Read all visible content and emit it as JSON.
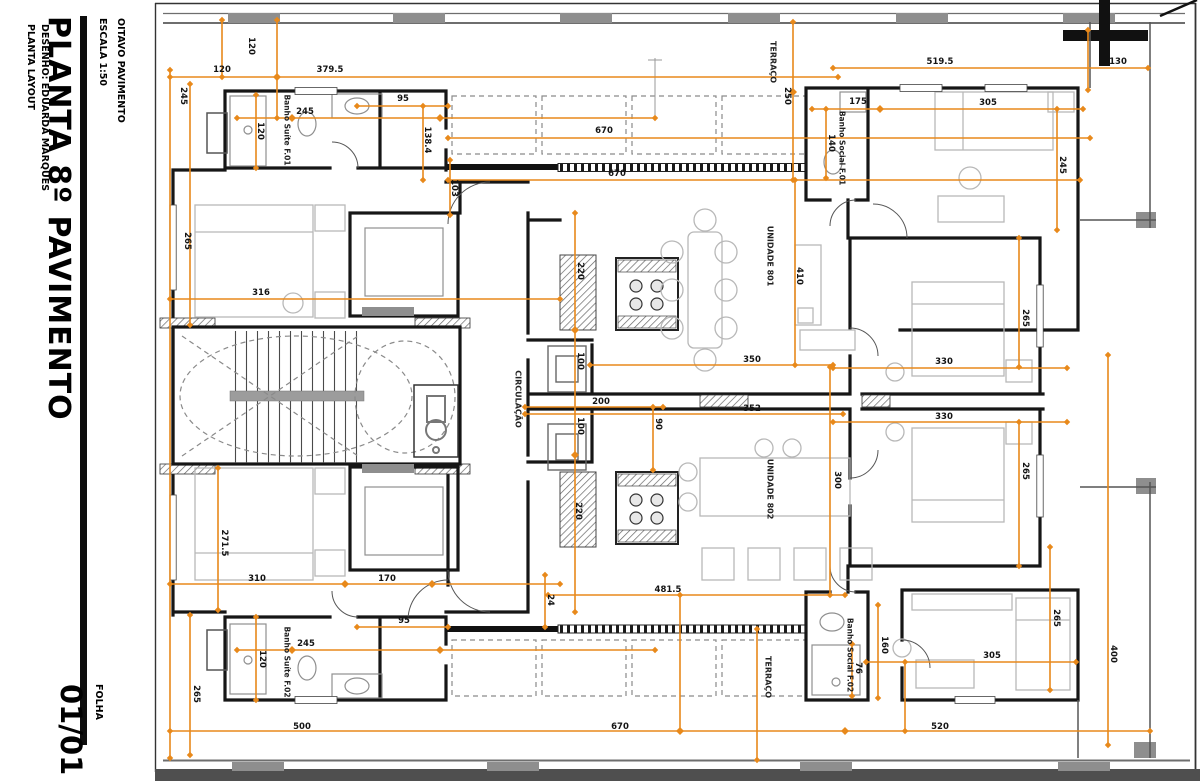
{
  "title_block": {
    "project": "OITAVO PAVIMENTO",
    "scale": "ESCALA 1:50",
    "title": "PLANTA 8º PAVIMENTO",
    "layout": "PLANTA LAYOUT",
    "author": "DESENHO: EDUARDA MARQUES",
    "sheet_label": "FOLHA",
    "sheet_number": "01/01"
  },
  "colors": {
    "dimension": "#E8891B",
    "wall": "#161616",
    "column_gray": "#8e8e8e",
    "furniture_gray": "#b8b8b8"
  },
  "plan": {
    "rooms": [
      {
        "text": "Banho Suíte F.01",
        "x": 287,
        "y": 130,
        "rot": 90,
        "size": 7.5
      },
      {
        "text": "Banho Social F.01",
        "x": 842,
        "y": 148,
        "rot": 90,
        "size": 7.5
      },
      {
        "text": "TERRAÇO",
        "x": 773,
        "y": 62,
        "rot": 90
      },
      {
        "text": "UNIDADE 801",
        "x": 770,
        "y": 256,
        "rot": 90
      },
      {
        "text": "CIRCULAÇÃO",
        "x": 518,
        "y": 399,
        "rot": 90
      },
      {
        "text": "UNIDADE 802",
        "x": 770,
        "y": 489,
        "rot": 90
      },
      {
        "text": "TERRAÇO",
        "x": 768,
        "y": 677,
        "rot": 90
      },
      {
        "text": "Banho Social F.02",
        "x": 850,
        "y": 655,
        "rot": 90,
        "size": 7.5
      },
      {
        "text": "Banho Suíte F.02",
        "x": 287,
        "y": 662,
        "rot": 90,
        "size": 7.5
      }
    ],
    "dimensions": [
      {
        "text": "120",
        "x": 222,
        "y": 70
      },
      {
        "text": "379.5",
        "x": 330,
        "y": 70
      },
      {
        "text": "519.5",
        "x": 940,
        "y": 62
      },
      {
        "text": "130",
        "x": 1118,
        "y": 62
      },
      {
        "text": "120",
        "x": 251,
        "y": 46,
        "rot": 90
      },
      {
        "text": "245",
        "x": 183,
        "y": 96,
        "rot": 90
      },
      {
        "text": "95",
        "x": 403,
        "y": 99
      },
      {
        "text": "245",
        "x": 305,
        "y": 112
      },
      {
        "text": "120",
        "x": 260,
        "y": 131,
        "rot": 90
      },
      {
        "text": "138.4",
        "x": 427,
        "y": 140,
        "rot": 90
      },
      {
        "text": "103",
        "x": 454,
        "y": 188,
        "rot": 90
      },
      {
        "text": "670",
        "x": 604,
        "y": 131
      },
      {
        "text": "670",
        "x": 617,
        "y": 174
      },
      {
        "text": "250",
        "x": 787,
        "y": 96,
        "rot": 90
      },
      {
        "text": "175",
        "x": 858,
        "y": 102
      },
      {
        "text": "140",
        "x": 831,
        "y": 143,
        "rot": 90
      },
      {
        "text": "305",
        "x": 988,
        "y": 103
      },
      {
        "text": "245",
        "x": 1062,
        "y": 165,
        "rot": 90
      },
      {
        "text": "265",
        "x": 187,
        "y": 241,
        "rot": 90
      },
      {
        "text": "316",
        "x": 261,
        "y": 293
      },
      {
        "text": "410",
        "x": 799,
        "y": 276,
        "rot": 90
      },
      {
        "text": "220",
        "x": 580,
        "y": 271,
        "rot": 90
      },
      {
        "text": "100",
        "x": 580,
        "y": 361,
        "rot": 90
      },
      {
        "text": "100",
        "x": 580,
        "y": 426,
        "rot": 90
      },
      {
        "text": "220",
        "x": 578,
        "y": 511,
        "rot": 90
      },
      {
        "text": "350",
        "x": 752,
        "y": 360
      },
      {
        "text": "352",
        "x": 752,
        "y": 409
      },
      {
        "text": "200",
        "x": 601,
        "y": 402
      },
      {
        "text": "90",
        "x": 658,
        "y": 424,
        "rot": 90
      },
      {
        "text": "330",
        "x": 944,
        "y": 362
      },
      {
        "text": "330",
        "x": 944,
        "y": 417
      },
      {
        "text": "265",
        "x": 1025,
        "y": 318,
        "rot": 90
      },
      {
        "text": "265",
        "x": 1025,
        "y": 471,
        "rot": 90
      },
      {
        "text": "300",
        "x": 837,
        "y": 480,
        "rot": 90
      },
      {
        "text": "271.5",
        "x": 224,
        "y": 543,
        "rot": 90
      },
      {
        "text": "310",
        "x": 257,
        "y": 579
      },
      {
        "text": "170",
        "x": 387,
        "y": 579
      },
      {
        "text": "481.5",
        "x": 668,
        "y": 590
      },
      {
        "text": "24",
        "x": 550,
        "y": 600,
        "rot": 90
      },
      {
        "text": "95",
        "x": 404,
        "y": 621
      },
      {
        "text": "245",
        "x": 306,
        "y": 644
      },
      {
        "text": "120",
        "x": 262,
        "y": 659,
        "rot": 90
      },
      {
        "text": "265",
        "x": 196,
        "y": 694,
        "rot": 90
      },
      {
        "text": "160",
        "x": 884,
        "y": 645,
        "rot": 90
      },
      {
        "text": "76",
        "x": 858,
        "y": 668,
        "rot": 90
      },
      {
        "text": "305",
        "x": 992,
        "y": 656
      },
      {
        "text": "265",
        "x": 1056,
        "y": 618,
        "rot": 90
      },
      {
        "text": "400",
        "x": 1113,
        "y": 654,
        "rot": 90
      },
      {
        "text": "500",
        "x": 302,
        "y": 727
      },
      {
        "text": "670",
        "x": 620,
        "y": 727
      },
      {
        "text": "520",
        "x": 940,
        "y": 727
      }
    ]
  }
}
